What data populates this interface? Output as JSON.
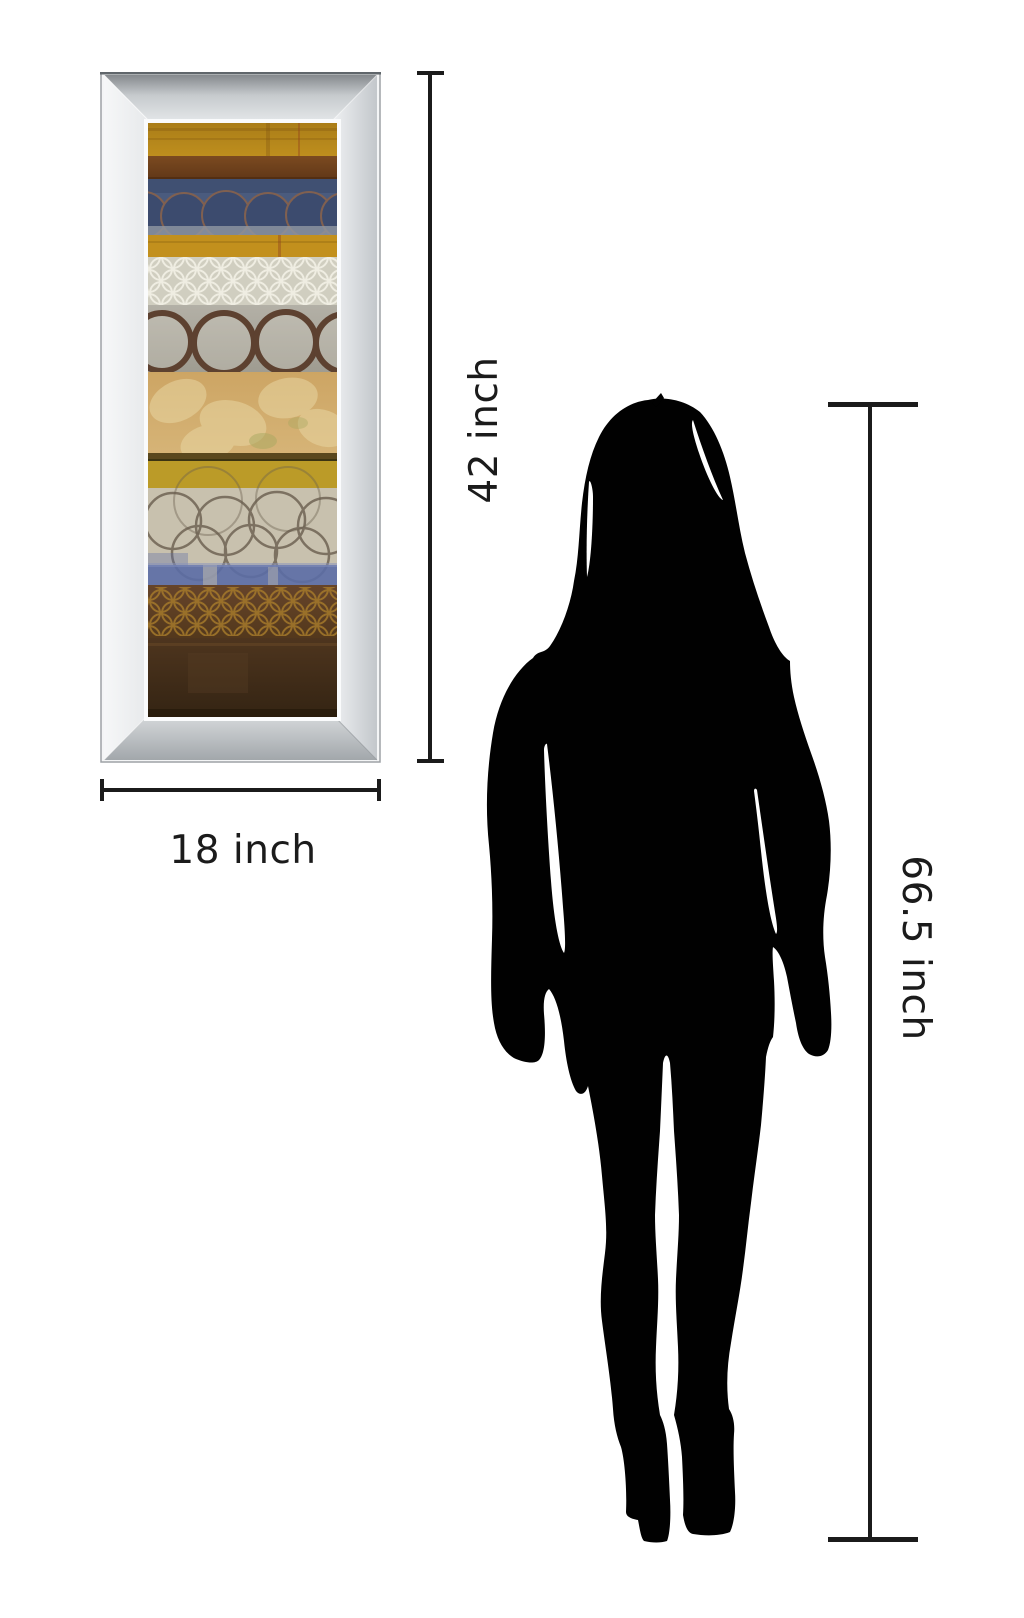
{
  "diagram": {
    "background_color": "#ffffff",
    "line_color": "#1b1b1b",
    "text_color": "#1b1b1b",
    "artwork": {
      "icon": "mirror-framed-abstract-art",
      "height_label": "42 inch",
      "width_label": "18 inch",
      "frame_colors": {
        "light": "#f4f5f6",
        "mid": "#c6cacd",
        "dark": "#9aa0a4"
      },
      "art_palette": [
        "#b5851f",
        "#71431f",
        "#4a5b7e",
        "#c2901d",
        "#d0cec0",
        "#a9a69b",
        "#cda564",
        "#bb9b28",
        "#c8c1ae",
        "#5b6da6",
        "#5d3e20",
        "#44301b"
      ]
    },
    "person": {
      "icon": "woman-silhouette",
      "height_label": "66.5 inch",
      "color": "#010101"
    }
  }
}
